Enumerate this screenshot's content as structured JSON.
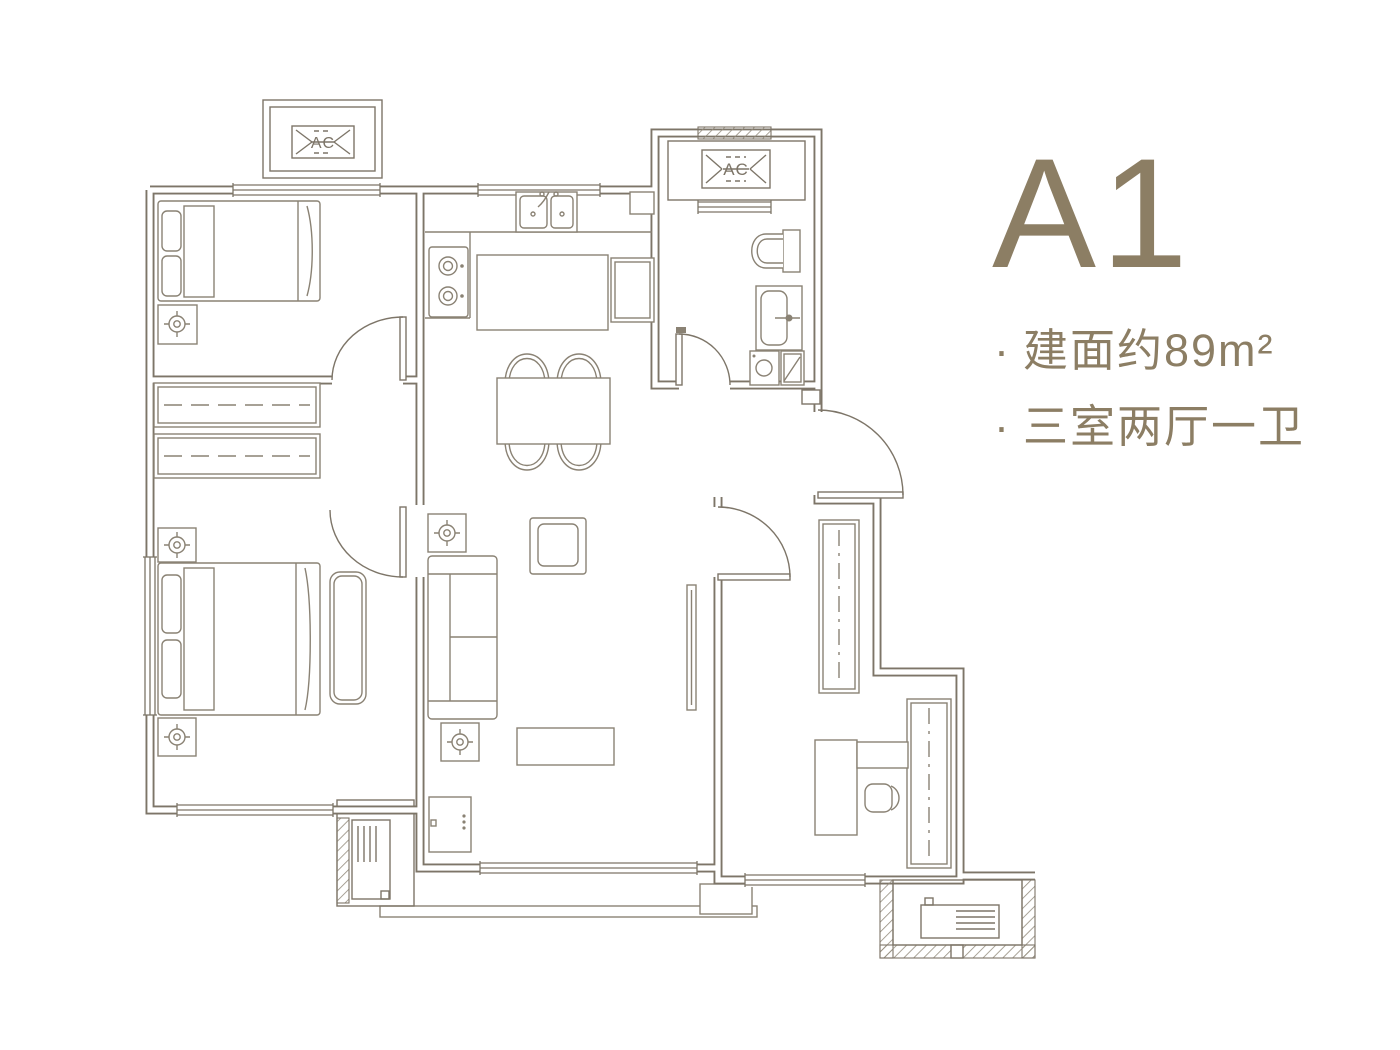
{
  "panel": {
    "unit_label": "A1",
    "bullet_char": "·",
    "bullets": [
      {
        "text": "建面约89m²"
      },
      {
        "text": "三室两厅一卫"
      }
    ]
  },
  "floorplan": {
    "ac_label": "AC"
  },
  "colors": {
    "wall": "#7d7568",
    "furniture": "#8a8274",
    "text": "#8c7e64",
    "background": "#ffffff"
  }
}
